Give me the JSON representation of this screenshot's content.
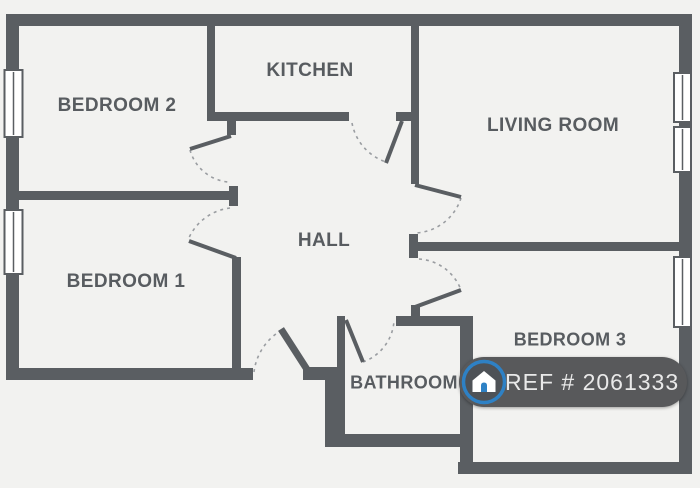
{
  "floor_plan": {
    "rooms": [
      {
        "id": "bedroom-2",
        "label": "BEDROOM 2"
      },
      {
        "id": "kitchen",
        "label": "KITCHEN"
      },
      {
        "id": "living-room",
        "label": "LIVING ROOM"
      },
      {
        "id": "hall",
        "label": "HALL"
      },
      {
        "id": "bedroom-1",
        "label": "BEDROOM 1"
      },
      {
        "id": "bathroom",
        "label": "BATHROOM"
      },
      {
        "id": "bedroom-3",
        "label": "BEDROOM 3"
      }
    ],
    "badge": {
      "ref": "REF # 2061333",
      "icon": "house-icon"
    },
    "colors": {
      "wall": "#5a5e62",
      "background": "#f2f2f0",
      "label_text": "#585c60",
      "door_swing": "#9a9da1",
      "window_fill": "#ffffff",
      "badge_background": "#58595b",
      "badge_text": "#e9e9e9",
      "accent_blue": "#2e81c5"
    }
  }
}
